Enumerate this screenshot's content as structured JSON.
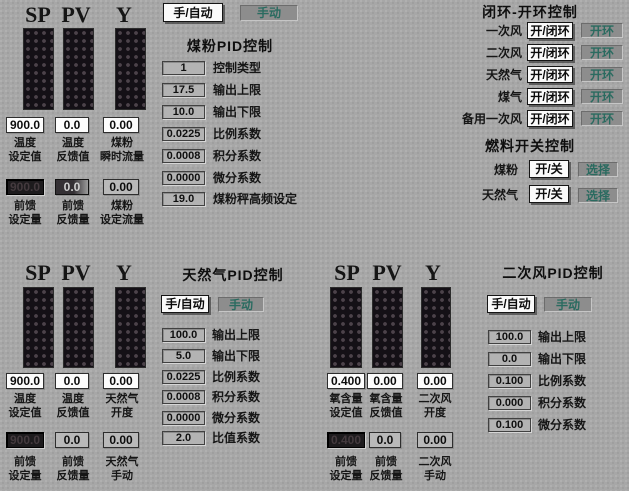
{
  "coal_bar": {
    "headers": [
      "SP",
      "PV",
      "Y"
    ],
    "values": [
      "900.0",
      "0.0",
      "0.00"
    ],
    "labels": [
      {
        "l1": "温度",
        "l2": "设定值"
      },
      {
        "l1": "温度",
        "l2": "反馈值"
      },
      {
        "l1": "煤粉",
        "l2": "瞬时流量"
      }
    ],
    "ff_values": [
      "900.0",
      "0.0",
      "0.00"
    ],
    "ff_labels": [
      {
        "l1": "前馈",
        "l2": "设定量"
      },
      {
        "l1": "前馈",
        "l2": "反馈量"
      },
      {
        "l1": "煤粉",
        "l2": "设定流量"
      }
    ]
  },
  "coal_pid": {
    "auto_button": "手/自动",
    "mode": "手动",
    "title": "煤粉PID控制",
    "params": [
      {
        "value": "1",
        "label": "控制类型"
      },
      {
        "value": "17.5",
        "label": "输出上限"
      },
      {
        "value": "10.0",
        "label": "输出下限"
      },
      {
        "value": "0.0225",
        "label": "比例系数"
      },
      {
        "value": "0.0008",
        "label": "积分系数"
      },
      {
        "value": "0.0000",
        "label": "微分系数"
      },
      {
        "value": "19.0",
        "label": "煤粉秤高频设定"
      }
    ]
  },
  "loop_panel": {
    "title": "闭环-开环控制",
    "rows": [
      {
        "label": "一次风",
        "button": "开/闭环",
        "status": "开环"
      },
      {
        "label": "二次风",
        "button": "开/闭环",
        "status": "开环"
      },
      {
        "label": "天然气",
        "button": "开/闭环",
        "status": "开环"
      },
      {
        "label": "煤气",
        "button": "开/闭环",
        "status": "开环"
      },
      {
        "label": "备用一次风",
        "button": "开/闭环",
        "status": "开环"
      }
    ],
    "fuel_title": "燃料开关控制",
    "fuel_rows": [
      {
        "label": "煤粉",
        "button": "开/关",
        "status": "选择"
      },
      {
        "label": "天然气",
        "button": "开/关",
        "status": "选择"
      }
    ]
  },
  "gas_bar": {
    "headers": [
      "SP",
      "PV",
      "Y"
    ],
    "values": [
      "900.0",
      "0.0",
      "0.00"
    ],
    "labels": [
      {
        "l1": "温度",
        "l2": "设定值"
      },
      {
        "l1": "温度",
        "l2": "反馈值"
      },
      {
        "l1": "天然气",
        "l2": "开度"
      }
    ],
    "ff_values": [
      "900.0",
      "0.0",
      "0.00"
    ],
    "ff_labels": [
      {
        "l1": "前馈",
        "l2": "设定量"
      },
      {
        "l1": "前馈",
        "l2": "反馈量"
      },
      {
        "l1": "天然气",
        "l2": "手动"
      }
    ]
  },
  "gas_pid": {
    "auto_button": "手/自动",
    "mode": "手动",
    "title": "天然气PID控制",
    "params": [
      {
        "value": "100.0",
        "label": "输出上限"
      },
      {
        "value": "5.0",
        "label": "输出下限"
      },
      {
        "value": "0.0225",
        "label": "比例系数"
      },
      {
        "value": "0.0008",
        "label": "积分系数"
      },
      {
        "value": "0.0000",
        "label": "微分系数"
      },
      {
        "value": "2.0",
        "label": "比值系数"
      }
    ]
  },
  "air_bar": {
    "headers": [
      "SP",
      "PV",
      "Y"
    ],
    "values": [
      "0.400",
      "0.00",
      "0.00"
    ],
    "labels": [
      {
        "l1": "氧含量",
        "l2": "设定值"
      },
      {
        "l1": "氧含量",
        "l2": "反馈值"
      },
      {
        "l1": "二次风",
        "l2": "开度"
      }
    ],
    "ff_values": [
      "0.400",
      "0.0",
      "0.00"
    ],
    "ff_labels": [
      {
        "l1": "前馈",
        "l2": "设定量"
      },
      {
        "l1": "前馈",
        "l2": "反馈量"
      },
      {
        "l1": "二次风",
        "l2": "手动"
      }
    ]
  },
  "air_pid": {
    "auto_button": "手/自动",
    "mode": "手动",
    "title": "二次风PID控制",
    "params": [
      {
        "value": "100.0",
        "label": "输出上限"
      },
      {
        "value": "0.0",
        "label": "输出下限"
      },
      {
        "value": "0.100",
        "label": "比例系数"
      },
      {
        "value": "0.000",
        "label": "积分系数"
      },
      {
        "value": "0.100",
        "label": "微分系数"
      }
    ]
  },
  "colors": {
    "background": "#a7a7a7",
    "status_teal": "#2a6b60",
    "field_white": "#fdfdfd",
    "param_gray": "#b3b3b3",
    "bar_dark": "#141016"
  }
}
